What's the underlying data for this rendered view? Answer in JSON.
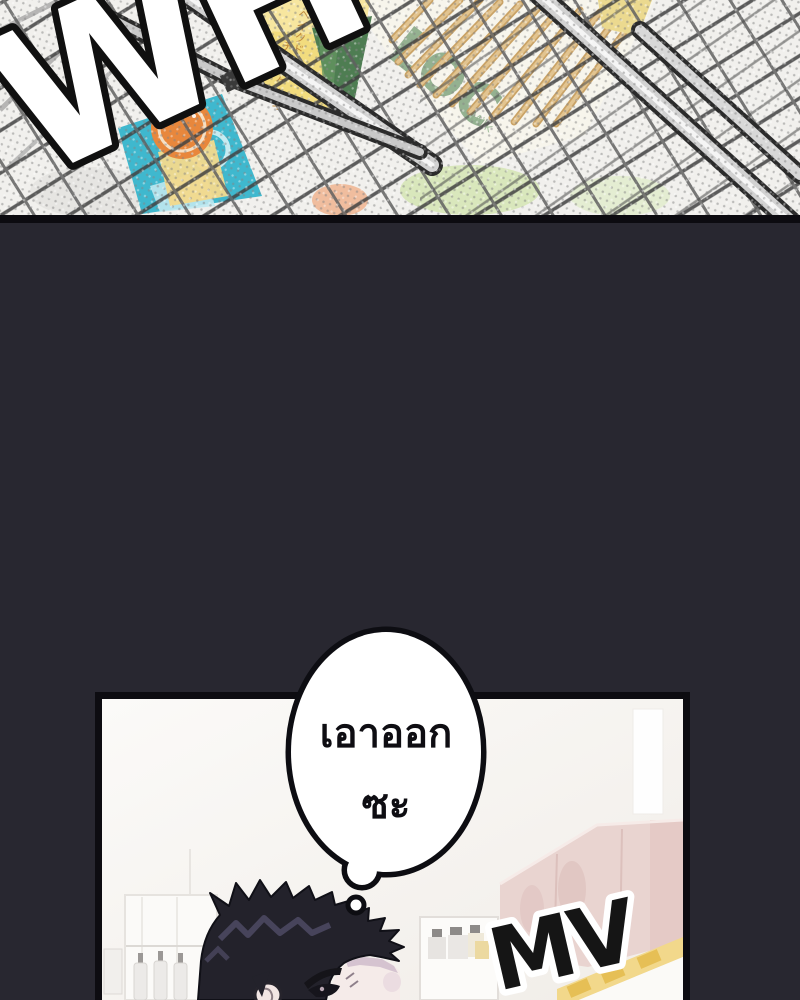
{
  "page": {
    "width": 800,
    "height": 1000,
    "background": "#282730"
  },
  "top_panel": {
    "description": "close-up of wire shopping basket with snacks, halftone screentone",
    "sfx_label": "WH",
    "product_cheesecake_line1": "ベイクド",
    "product_cheesecake_line2": "チーズケーキ",
    "product_snack_brand": "LOC",
    "product_snack_sub": "Milk",
    "colors": {
      "background": "#f1f0ed",
      "border": "#0c0b10",
      "basket_wire": "#414141",
      "basket_rim": "#d2d2d2",
      "cheesecake_box": "#f2dc7e",
      "snack_green": "#8fae8c",
      "pretzel_stick": "#e2c490",
      "teal_product": "#3fb8ce",
      "orange_logo": "#e8873c"
    }
  },
  "gutter": {
    "background": "#282730"
  },
  "bottom_panel": {
    "description": "convenience store scene, spiky-haired character thinking",
    "thought_bubble": {
      "line1": "เอาออก",
      "line2": "ซะ"
    },
    "sfx_label": "MV",
    "colors": {
      "background": "#f6f4f1",
      "border": "#0d0c11",
      "shelf_pink": "#e9d4d0",
      "price_strip_yellow": "#f2d88b",
      "hair": "#23222b",
      "hair_highlight": "#4b4860",
      "skin": "#f5ebe9",
      "bubble_outline": "#0d0d12"
    }
  }
}
